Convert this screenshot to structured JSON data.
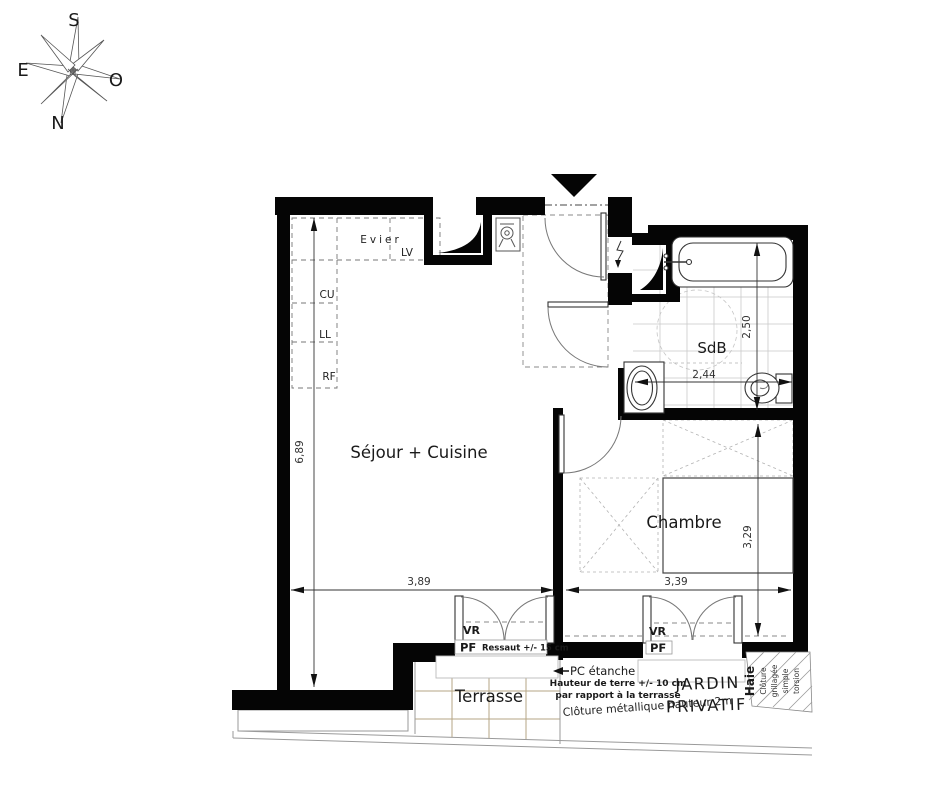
{
  "compass": {
    "s": "S",
    "e": "E",
    "o": "O",
    "n": "N"
  },
  "kitchen": {
    "evier": "Evier",
    "lv": "LV",
    "cu": "CU",
    "ll": "LL",
    "rf": "RF"
  },
  "rooms": {
    "living": "Séjour + Cuisine",
    "bathroom": "SdB",
    "bedroom": "Chambre",
    "terrace": "Terrasse"
  },
  "garden": {
    "line1": "JARDIN",
    "line2": "PRIVATIF"
  },
  "dimensions": {
    "living_height": "6,89",
    "living_width": "3,89",
    "bedroom_width": "3,39",
    "bedroom_height": "3,29",
    "bathroom_width": "2,44",
    "bathroom_height": "2,50"
  },
  "openings": {
    "vr1": "VR",
    "pf1": "PF",
    "ressaut": "Ressaut +/- 15 cm",
    "vr2": "VR",
    "pf2": "PF"
  },
  "annotations": {
    "pc_etanche": "PC étanche",
    "terre_line1": "Hauteur de terre +/- 10 cm",
    "terre_line2": "par rapport à la terrasse",
    "cloture_metal": "Clôture métallique hauteur 2m",
    "haie": "Haie",
    "grillage1": "Clôture",
    "grillage2": "grillagée",
    "grillage3": "simple",
    "grillage4": "torsion"
  },
  "colors": {
    "wall": "#050505",
    "terrace_grid": "#b5a584",
    "bath_tile": "#c9c9c9",
    "dash": "#888888"
  }
}
